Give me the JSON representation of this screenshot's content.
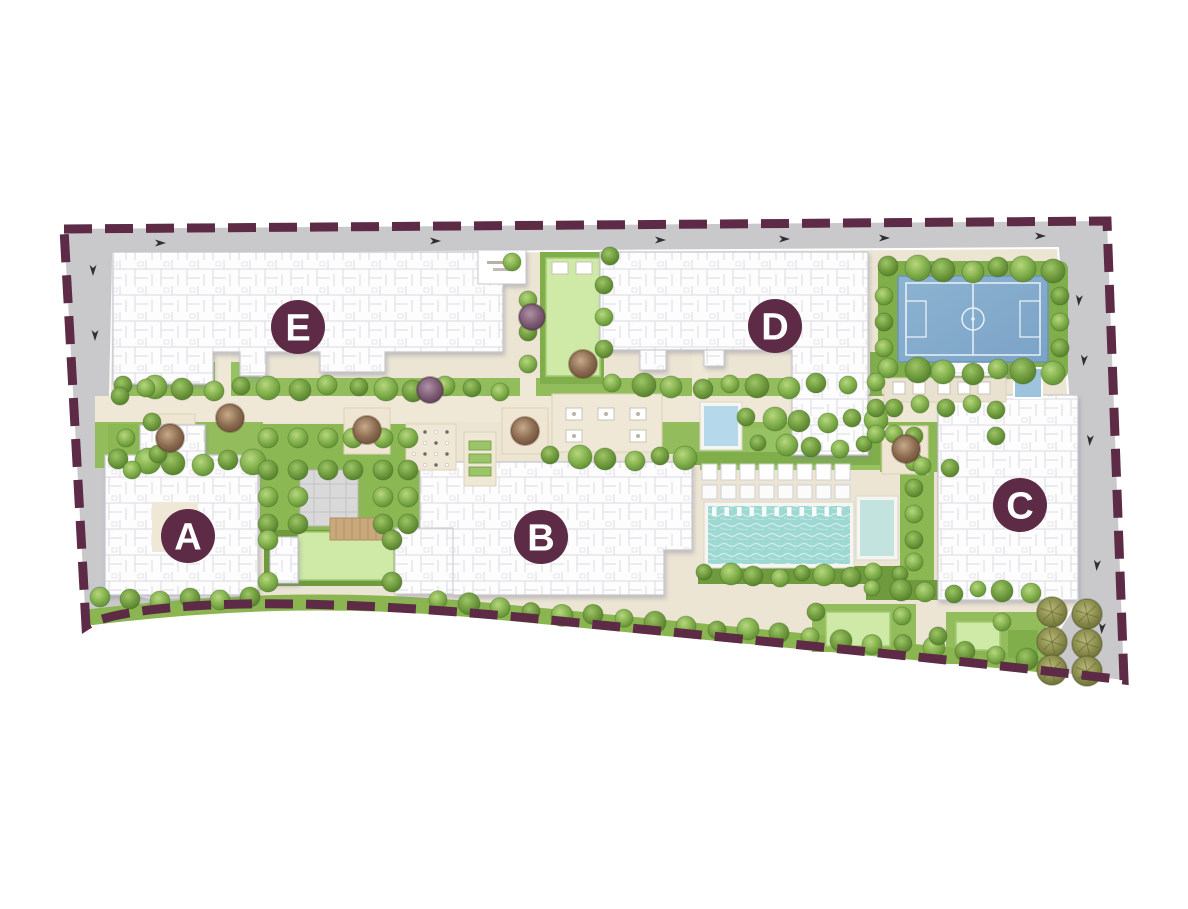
{
  "app": {
    "type": "master-plan-map",
    "background": "#ffffff"
  },
  "boundary": {
    "color": "#5d2b46",
    "style": "dashed"
  },
  "badges": {
    "fill": "#5d2b46",
    "text_color": "#ffffff",
    "items": [
      {
        "id": "badge-a",
        "letter": "A"
      },
      {
        "id": "badge-b",
        "letter": "B"
      },
      {
        "id": "badge-c",
        "letter": "C"
      },
      {
        "id": "badge-d",
        "letter": "D"
      },
      {
        "id": "badge-e",
        "letter": "E"
      }
    ]
  },
  "features": [
    {
      "name": "sports-court",
      "color": "#84accb"
    },
    {
      "name": "swimming-pool",
      "color": "#9ed8d2"
    },
    {
      "name": "plunge-pool",
      "color": "#c2e3de"
    },
    {
      "name": "kids-pool",
      "color": "#b5d8ea"
    },
    {
      "name": "lawns",
      "color": "#cfe9a6"
    },
    {
      "name": "landscape-green",
      "color": "#93bd5c"
    },
    {
      "name": "perimeter-road",
      "color": "#c9c9cc"
    },
    {
      "name": "buildings",
      "color": "#ffffff"
    },
    {
      "name": "palm-court",
      "color": "#9aa05a"
    }
  ]
}
